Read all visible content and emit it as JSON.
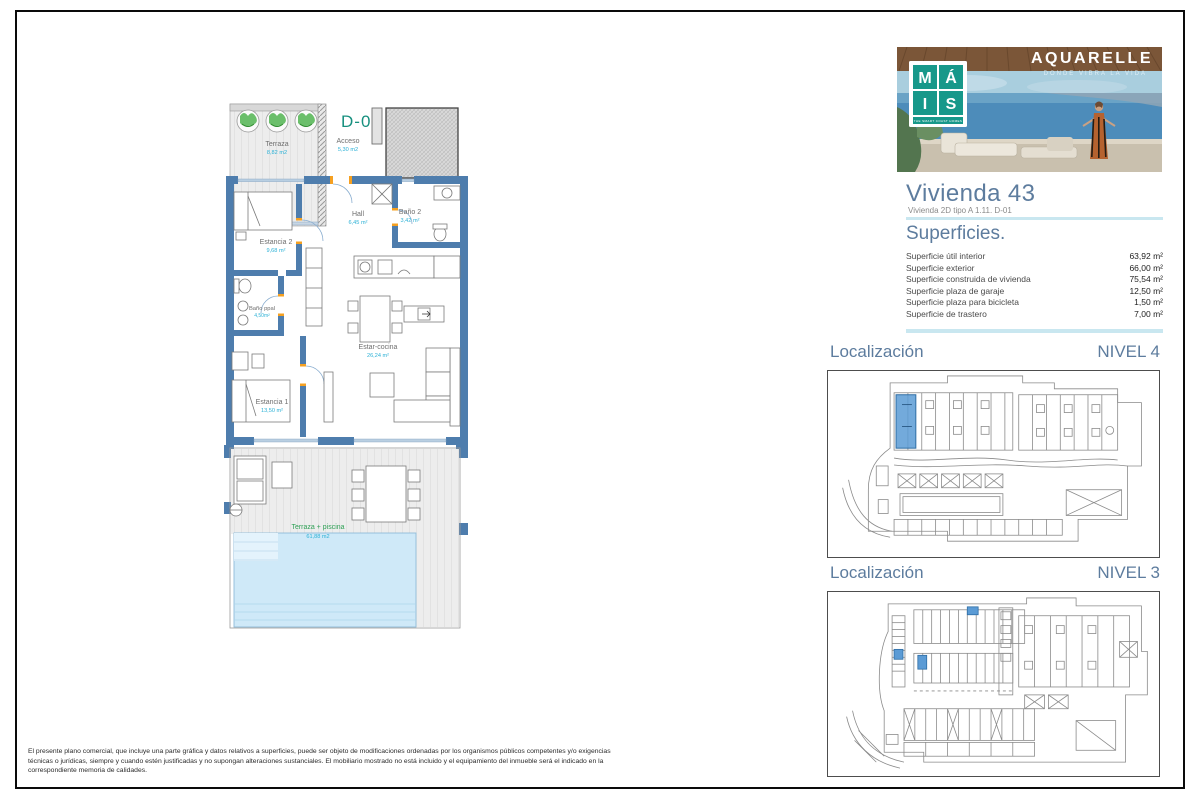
{
  "brand": {
    "logo_letters": [
      "M",
      "Á",
      "I",
      "S"
    ],
    "logo_tagline": "THE SMART COAST HOMES",
    "banner_title": "AQUARELLE",
    "banner_subtitle": "DONDE VIBRA LA VIDA"
  },
  "unit": {
    "title": "Vivienda 43",
    "subtitle": "Vivienda 2D tipo A 1.11. D-01"
  },
  "superficies": {
    "heading": "Superficies.",
    "rows": [
      {
        "label": "Superficie útil interior",
        "value": "63,92 m²"
      },
      {
        "label": "Superficie exterior",
        "value": "66,00 m²"
      },
      {
        "label": "Superficie construida de vivienda",
        "value": "75,54 m²"
      },
      {
        "label": "Superficie plaza de garaje",
        "value": "12,50 m²"
      },
      {
        "label": "Superficie plaza para bicicleta",
        "value": "1,50 m²"
      },
      {
        "label": "Superficie de trastero",
        "value": "7,00 m²"
      }
    ]
  },
  "localizacion": {
    "nivel4": {
      "label": "Localización",
      "level": "NIVEL 4"
    },
    "nivel3": {
      "label": "Localización",
      "level": "NIVEL 3"
    }
  },
  "floorplan": {
    "code": "D-01",
    "rooms": [
      {
        "name": "Terraza",
        "area": "8,82 m2"
      },
      {
        "name": "Acceso",
        "area": "5,30 m2"
      },
      {
        "name": "Hall",
        "area": "6,45 m²"
      },
      {
        "name": "Baño 2",
        "area": "3,42 m²"
      },
      {
        "name": "Estancia 2",
        "area": "9,68 m²"
      },
      {
        "name": "Baño ppal",
        "area": "4,50m²"
      },
      {
        "name": "Estar-cocina",
        "area": "26,24 m²"
      },
      {
        "name": "Estancia 1",
        "area": "13,50 m²"
      },
      {
        "name": "Terraza + piscina",
        "area": "61,88 m2"
      }
    ]
  },
  "disclaimer": "El presente plano comercial, que incluye una parte gráfica y datos relativos a superficies, puede ser objeto de modificaciones ordenadas por los organismos públicos competentes y/o exigencias técnicas o jurídicas, siempre y cuando estén justificadas y no supongan alteraciones sustanciales. El mobiliario mostrado no está incluido y el equipamiento del inmueble será el indicado en la correspondiente memoria de calidades.",
  "colors": {
    "wall_blue": "#4e7dad",
    "teal": "#17988a",
    "cyan_label": "#2cb1d6",
    "green_label": "#2fa156",
    "heading_blue": "#5d7c9e",
    "divider": "#c9e7f0",
    "highlight_blue": "#5b9bd5",
    "accent_orange": "#f5a021"
  }
}
